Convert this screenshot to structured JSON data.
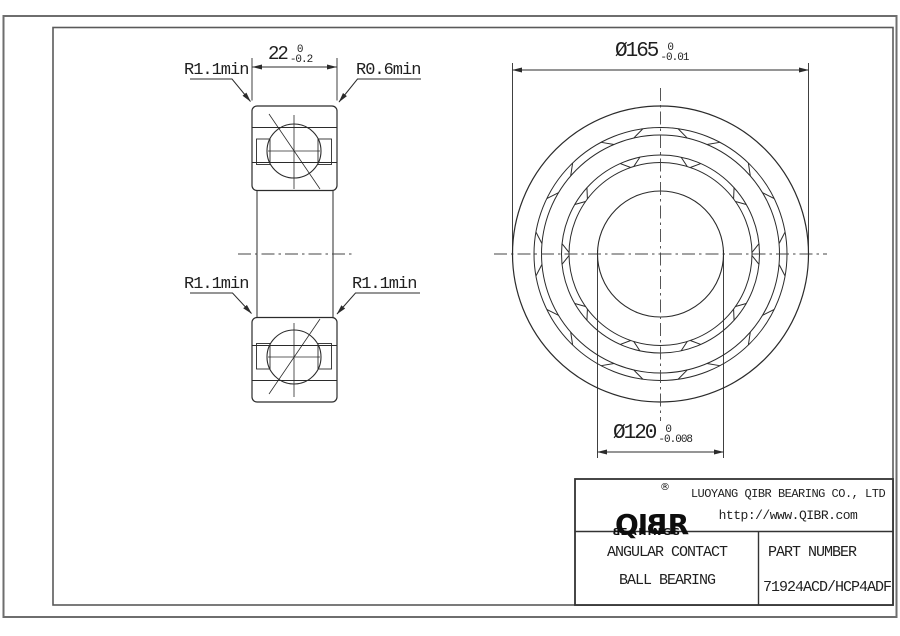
{
  "page": {
    "background": "#ffffff",
    "line_color": "#2b2b2b",
    "border_color": "#6e6e6e"
  },
  "dimensions": {
    "width": {
      "value": "22",
      "tol_upper": "0",
      "tol_lower": "-0.2"
    },
    "outer_diameter": {
      "value": "Ø165",
      "tol_upper": "0",
      "tol_lower": "-0.01"
    },
    "bore_diameter": {
      "value": "Ø120",
      "tol_upper": "0",
      "tol_lower": "-0.008"
    }
  },
  "radius_labels": {
    "top_left": "R1.1min",
    "top_right": "R0.6min",
    "bottom_left": "R1.1min",
    "bottom_right": "R1.1min"
  },
  "title_block": {
    "logo": {
      "pre": "QI",
      "flipped_letter": "B",
      "post": "R",
      "registered": "®",
      "sub_flipped_letter": "B",
      "sub_rest": "EARINGS"
    },
    "company": "LUOYANG QIBR BEARING CO., LTD",
    "website": "http://www.QIBR.com",
    "product_line1": "ANGULAR CONTACT",
    "product_line2": "BALL BEARING",
    "part_label": "PART NUMBER",
    "part_number": "71924ACD/HCP4ADF"
  }
}
